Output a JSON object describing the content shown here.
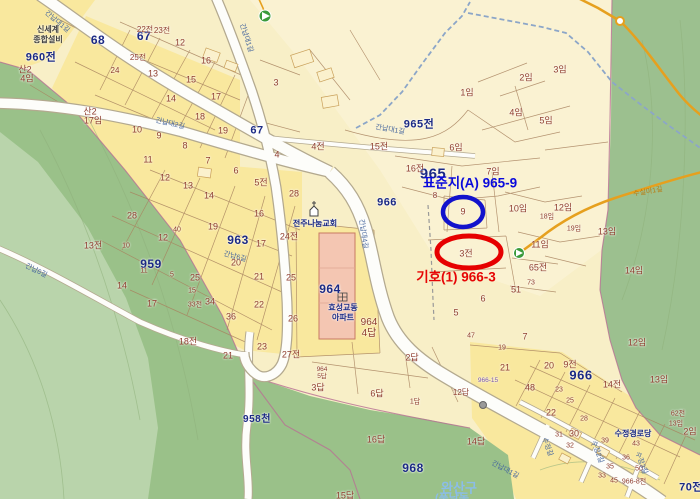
{
  "title": "지적도 화면 (cadastral map view)",
  "annotations": {
    "blue_label": "표준지(A) 965-9",
    "red_label": "기호(1) 966-3",
    "blue_circled_parcel": "9",
    "red_circled_parcel": "3전"
  },
  "district": "완산구",
  "places": [
    "전주나눔교회",
    "효성교동 아파트",
    "수정경로당",
    "신세계 종합설비"
  ],
  "road_names": [
    "간납대1길",
    "간납대2길",
    "간납대4길",
    "간납6길",
    "수정길",
    "수정2길",
    "수정3길",
    "수실마1길"
  ],
  "major_parcels": [
    "960전",
    "68",
    "67",
    "959",
    "963",
    "964",
    "965",
    "965전",
    "966",
    "968",
    "958천",
    "70전"
  ],
  "markers": [
    {
      "icon": "trail-start-icon",
      "x": 265,
      "y": 16
    },
    {
      "icon": "trail-start-icon",
      "x": 519,
      "y": 253
    },
    {
      "icon": "road-node-icon",
      "x": 620,
      "y": 21
    },
    {
      "icon": "junction-dot-icon",
      "x": 483,
      "y": 405
    },
    {
      "icon": "church-icon",
      "x": 314,
      "y": 211
    },
    {
      "icon": "apartment-icon",
      "x": 342,
      "y": 297
    }
  ],
  "colors": {
    "base": "#f8efc7",
    "bright_block": "#f9e89e",
    "light_block": "#faf2d2",
    "forest_medium": "#9ac189",
    "forest_light": "#b9d4ab",
    "forest_right": "#9cc08f",
    "road_fill": "#fdfdfa",
    "road_casing": "#b3a98f",
    "stream": "#8ca6c8",
    "orange_road": "#e6a01e",
    "parcel_line": "#a8835f",
    "label_brick": "#8f3d2e",
    "label_navy": "#1b2a85",
    "annotation_blue": "#1212cc",
    "annotation_red": "#e60000",
    "apartment_fill": "#f4c6b2"
  },
  "labels": [
    {
      "t": "960전",
      "x": 41,
      "y": 58,
      "k": "major",
      "s": 11,
      "n": "parcel-label-960"
    },
    {
      "t": "68",
      "x": 98,
      "y": 40,
      "k": "major",
      "s": 12,
      "n": "parcel-label-68"
    },
    {
      "t": "67",
      "x": 144,
      "y": 36,
      "k": "major",
      "s": 12,
      "n": "parcel-label-67"
    },
    {
      "t": "67",
      "x": 257,
      "y": 131,
      "k": "major",
      "s": 11,
      "n": "parcel-label-67b"
    },
    {
      "t": "965전",
      "x": 419,
      "y": 125,
      "k": "major",
      "s": 11,
      "n": "parcel-label-965jeon"
    },
    {
      "t": "959",
      "x": 151,
      "y": 264,
      "k": "major",
      "s": 12,
      "n": "parcel-label-959"
    },
    {
      "t": "963",
      "x": 238,
      "y": 240,
      "k": "major",
      "s": 12,
      "n": "parcel-label-963"
    },
    {
      "t": "964",
      "x": 330,
      "y": 289,
      "k": "major",
      "s": 12,
      "n": "parcel-label-964"
    },
    {
      "t": "965",
      "x": 433,
      "y": 174,
      "k": "major",
      "s": 15,
      "n": "parcel-label-965"
    },
    {
      "t": "966",
      "x": 387,
      "y": 203,
      "k": "major",
      "s": 11,
      "n": "parcel-label-966"
    },
    {
      "t": "966",
      "x": 581,
      "y": 375,
      "k": "major",
      "s": 13,
      "n": "parcel-label-966b"
    },
    {
      "t": "968",
      "x": 413,
      "y": 468,
      "k": "major",
      "s": 12,
      "n": "parcel-label-968"
    },
    {
      "t": "958천",
      "x": 257,
      "y": 420,
      "k": "major",
      "s": 10,
      "n": "parcel-label-958"
    },
    {
      "t": "70전",
      "x": 691,
      "y": 488,
      "k": "major",
      "s": 11,
      "n": "parcel-label-70"
    },
    {
      "t": "표준지(A) 965-9",
      "x": 470,
      "y": 183,
      "k": "ab",
      "n": "standard-lot-annotation"
    },
    {
      "t": "기호(1) 966-3",
      "x": 456,
      "y": 277,
      "k": "ar",
      "n": "subject-lot-annotation"
    },
    {
      "t": "전주나눔교회",
      "x": 315,
      "y": 224,
      "k": "poi",
      "n": "church-label"
    },
    {
      "t": "효성교동",
      "x": 343,
      "y": 308,
      "k": "poi",
      "n": "apartment-label-1"
    },
    {
      "t": "아파트",
      "x": 343,
      "y": 318,
      "k": "poi",
      "n": "apartment-label-2"
    },
    {
      "t": "수정경로당",
      "x": 633,
      "y": 434,
      "k": "poi",
      "n": "senior-center-label"
    },
    {
      "t": "신세계",
      "x": 48,
      "y": 30,
      "k": "gray",
      "n": "shop-label-1"
    },
    {
      "t": "종합설비",
      "x": 48,
      "y": 40,
      "k": "gray",
      "n": "shop-label-2"
    },
    {
      "t": "완산구",
      "x": 459,
      "y": 488,
      "k": "district",
      "n": "district-label"
    },
    {
      "t": "(풍남동",
      "x": 452,
      "y": 499,
      "k": "district",
      "s": 11,
      "n": "district-label-2"
    },
    {
      "t": "산2",
      "x": 25,
      "y": 70
    },
    {
      "t": "4임",
      "x": 27,
      "y": 79
    },
    {
      "t": "산2",
      "x": 90,
      "y": 112
    },
    {
      "t": "17임",
      "x": 93,
      "y": 121
    },
    {
      "t": "13전",
      "x": 93,
      "y": 246
    },
    {
      "t": "14",
      "x": 122,
      "y": 286
    },
    {
      "t": "17",
      "x": 152,
      "y": 304
    },
    {
      "t": "18전",
      "x": 188,
      "y": 342
    },
    {
      "t": "21",
      "x": 228,
      "y": 356
    },
    {
      "t": "16답",
      "x": 376,
      "y": 440
    },
    {
      "t": "14답",
      "x": 476,
      "y": 442
    },
    {
      "t": "15답",
      "x": 345,
      "y": 496
    },
    {
      "t": "12임",
      "x": 637,
      "y": 343
    },
    {
      "t": "13임",
      "x": 659,
      "y": 380
    },
    {
      "t": "2임",
      "x": 690,
      "y": 432
    },
    {
      "t": "13임",
      "x": 676,
      "y": 424,
      "k": "tiny"
    },
    {
      "t": "14임",
      "x": 634,
      "y": 271
    },
    {
      "t": "13임",
      "x": 607,
      "y": 232
    },
    {
      "t": "24",
      "x": 115,
      "y": 71,
      "k": "tiny",
      "s": 8
    },
    {
      "t": "25전",
      "x": 138,
      "y": 58,
      "k": "tiny",
      "s": 8
    },
    {
      "t": "22전",
      "x": 145,
      "y": 30,
      "k": "tiny",
      "s": 8
    },
    {
      "t": "23전",
      "x": 162,
      "y": 31,
      "k": "tiny",
      "s": 8
    },
    {
      "t": "12",
      "x": 180,
      "y": 43
    },
    {
      "t": "16",
      "x": 206,
      "y": 61
    },
    {
      "t": "13",
      "x": 153,
      "y": 74
    },
    {
      "t": "15",
      "x": 191,
      "y": 80
    },
    {
      "t": "14",
      "x": 171,
      "y": 99
    },
    {
      "t": "17",
      "x": 216,
      "y": 97
    },
    {
      "t": "18",
      "x": 200,
      "y": 117
    },
    {
      "t": "19",
      "x": 223,
      "y": 131
    },
    {
      "t": "10",
      "x": 137,
      "y": 130
    },
    {
      "t": "9",
      "x": 159,
      "y": 136
    },
    {
      "t": "8",
      "x": 185,
      "y": 146
    },
    {
      "t": "11",
      "x": 148,
      "y": 160
    },
    {
      "t": "3",
      "x": 276,
      "y": 83
    },
    {
      "t": "4",
      "x": 277,
      "y": 155
    },
    {
      "t": "4전",
      "x": 318,
      "y": 147
    },
    {
      "t": "15전",
      "x": 379,
      "y": 147
    },
    {
      "t": "16전",
      "x": 415,
      "y": 169
    },
    {
      "t": "6임",
      "x": 456,
      "y": 148
    },
    {
      "t": "1임",
      "x": 467,
      "y": 93
    },
    {
      "t": "2임",
      "x": 526,
      "y": 78
    },
    {
      "t": "3임",
      "x": 560,
      "y": 70
    },
    {
      "t": "4임",
      "x": 516,
      "y": 113
    },
    {
      "t": "5임",
      "x": 546,
      "y": 121
    },
    {
      "t": "7임",
      "x": 493,
      "y": 172
    },
    {
      "t": "8",
      "x": 435,
      "y": 196,
      "k": "tiny",
      "s": 8
    },
    {
      "t": "9",
      "x": 463,
      "y": 212,
      "n": "blue-circled-parcel"
    },
    {
      "t": "10임",
      "x": 518,
      "y": 209
    },
    {
      "t": "12임",
      "x": 563,
      "y": 208
    },
    {
      "t": "18임",
      "x": 547,
      "y": 217,
      "k": "tiny"
    },
    {
      "t": "19임",
      "x": 574,
      "y": 229,
      "k": "tiny"
    },
    {
      "t": "11임",
      "x": 540,
      "y": 245
    },
    {
      "t": "65전",
      "x": 538,
      "y": 268
    },
    {
      "t": "73",
      "x": 531,
      "y": 283,
      "k": "tiny"
    },
    {
      "t": "51",
      "x": 516,
      "y": 290
    },
    {
      "t": "3전",
      "x": 466,
      "y": 254,
      "n": "red-circled-parcel"
    },
    {
      "t": "6",
      "x": 483,
      "y": 299
    },
    {
      "t": "5",
      "x": 456,
      "y": 313
    },
    {
      "t": "7",
      "x": 208,
      "y": 161
    },
    {
      "t": "6",
      "x": 236,
      "y": 171
    },
    {
      "t": "5전",
      "x": 261,
      "y": 183
    },
    {
      "t": "16",
      "x": 259,
      "y": 214
    },
    {
      "t": "17",
      "x": 261,
      "y": 244
    },
    {
      "t": "20",
      "x": 236,
      "y": 263
    },
    {
      "t": "21",
      "x": 259,
      "y": 277
    },
    {
      "t": "22",
      "x": 259,
      "y": 305
    },
    {
      "t": "24전",
      "x": 289,
      "y": 237
    },
    {
      "t": "25",
      "x": 291,
      "y": 278
    },
    {
      "t": "26",
      "x": 293,
      "y": 319
    },
    {
      "t": "28",
      "x": 294,
      "y": 194
    },
    {
      "t": "12",
      "x": 165,
      "y": 178
    },
    {
      "t": "13",
      "x": 188,
      "y": 186
    },
    {
      "t": "14",
      "x": 209,
      "y": 196
    },
    {
      "t": "28",
      "x": 132,
      "y": 216
    },
    {
      "t": "19",
      "x": 213,
      "y": 227
    },
    {
      "t": "12",
      "x": 163,
      "y": 238
    },
    {
      "t": "10",
      "x": 126,
      "y": 246,
      "k": "tiny"
    },
    {
      "t": "40",
      "x": 177,
      "y": 230,
      "k": "tiny"
    },
    {
      "t": "11",
      "x": 144,
      "y": 271,
      "k": "tiny"
    },
    {
      "t": "5",
      "x": 172,
      "y": 275,
      "k": "tiny"
    },
    {
      "t": "25",
      "x": 195,
      "y": 278
    },
    {
      "t": "15",
      "x": 192,
      "y": 291,
      "k": "tiny"
    },
    {
      "t": "34",
      "x": 210,
      "y": 302
    },
    {
      "t": "33전",
      "x": 195,
      "y": 305,
      "k": "tiny"
    },
    {
      "t": "36",
      "x": 231,
      "y": 317
    },
    {
      "t": "964",
      "x": 369,
      "y": 323,
      "s": 10
    },
    {
      "t": "4답",
      "x": 369,
      "y": 334,
      "s": 10
    },
    {
      "t": "964",
      "x": 322,
      "y": 370,
      "k": "tiny",
      "s": 6.5
    },
    {
      "t": "5답",
      "x": 322,
      "y": 377,
      "k": "tiny",
      "s": 6.5
    },
    {
      "t": "3답",
      "x": 318,
      "y": 388
    },
    {
      "t": "23",
      "x": 262,
      "y": 347
    },
    {
      "t": "27전",
      "x": 291,
      "y": 355
    },
    {
      "t": "6답",
      "x": 377,
      "y": 394
    },
    {
      "t": "2답",
      "x": 412,
      "y": 358
    },
    {
      "t": "1답",
      "x": 415,
      "y": 402,
      "k": "tiny"
    },
    {
      "t": "12답",
      "x": 461,
      "y": 393,
      "s": 8
    },
    {
      "t": "7",
      "x": 525,
      "y": 337
    },
    {
      "t": "47",
      "x": 471,
      "y": 336,
      "k": "tiny"
    },
    {
      "t": "19",
      "x": 502,
      "y": 348,
      "k": "tiny"
    },
    {
      "t": "21",
      "x": 505,
      "y": 368
    },
    {
      "t": "48",
      "x": 530,
      "y": 388
    },
    {
      "t": "20",
      "x": 549,
      "y": 366
    },
    {
      "t": "9전",
      "x": 570,
      "y": 365
    },
    {
      "t": "14전",
      "x": 612,
      "y": 385
    },
    {
      "t": "23",
      "x": 559,
      "y": 390,
      "k": "tiny"
    },
    {
      "t": "25",
      "x": 570,
      "y": 401,
      "k": "tiny"
    },
    {
      "t": "22",
      "x": 551,
      "y": 413
    },
    {
      "t": "28",
      "x": 584,
      "y": 419,
      "k": "tiny"
    },
    {
      "t": "30",
      "x": 574,
      "y": 434
    },
    {
      "t": "31",
      "x": 559,
      "y": 435,
      "k": "tiny"
    },
    {
      "t": "32",
      "x": 570,
      "y": 446,
      "k": "tiny"
    },
    {
      "t": "39",
      "x": 605,
      "y": 441,
      "k": "tiny"
    },
    {
      "t": "43",
      "x": 636,
      "y": 444,
      "k": "tiny"
    },
    {
      "t": "35",
      "x": 610,
      "y": 467,
      "k": "tiny"
    },
    {
      "t": "36",
      "x": 626,
      "y": 458,
      "k": "tiny"
    },
    {
      "t": "33",
      "x": 602,
      "y": 476,
      "k": "tiny"
    },
    {
      "t": "45",
      "x": 614,
      "y": 481,
      "k": "tiny"
    },
    {
      "t": "50",
      "x": 639,
      "y": 469,
      "k": "tiny"
    },
    {
      "t": "62전",
      "x": 678,
      "y": 414,
      "k": "tiny"
    },
    {
      "t": "966-8전",
      "x": 634,
      "y": 482,
      "k": "tiny"
    },
    {
      "t": "966-15",
      "x": 488,
      "y": 381,
      "k": "purple"
    },
    {
      "t": "간납대1길",
      "x": 57,
      "y": 22,
      "k": "road",
      "r": 40
    },
    {
      "t": "간납대1길",
      "x": 246,
      "y": 38,
      "k": "road",
      "r": 72
    },
    {
      "t": "간납대1길",
      "x": 390,
      "y": 130,
      "k": "road",
      "r": 10
    },
    {
      "t": "간납대2길",
      "x": 170,
      "y": 124,
      "k": "road",
      "r": 13
    },
    {
      "t": "간납대4길",
      "x": 363,
      "y": 234,
      "k": "road",
      "r": 82
    },
    {
      "t": "간납6길",
      "x": 36,
      "y": 271,
      "k": "road",
      "r": 26
    },
    {
      "t": "간납6길",
      "x": 235,
      "y": 257,
      "k": "road",
      "r": 15
    },
    {
      "t": "간납대1길",
      "x": 505,
      "y": 470,
      "k": "road",
      "r": 28
    },
    {
      "t": "수정길",
      "x": 547,
      "y": 447,
      "k": "road",
      "r": 70
    },
    {
      "t": "수정2길",
      "x": 597,
      "y": 452,
      "k": "road",
      "r": 70
    },
    {
      "t": "수정3길",
      "x": 641,
      "y": 463,
      "k": "road",
      "r": 70
    },
    {
      "t": "수실마1길",
      "x": 648,
      "y": 192,
      "k": "roadOrange",
      "r": -10
    }
  ]
}
